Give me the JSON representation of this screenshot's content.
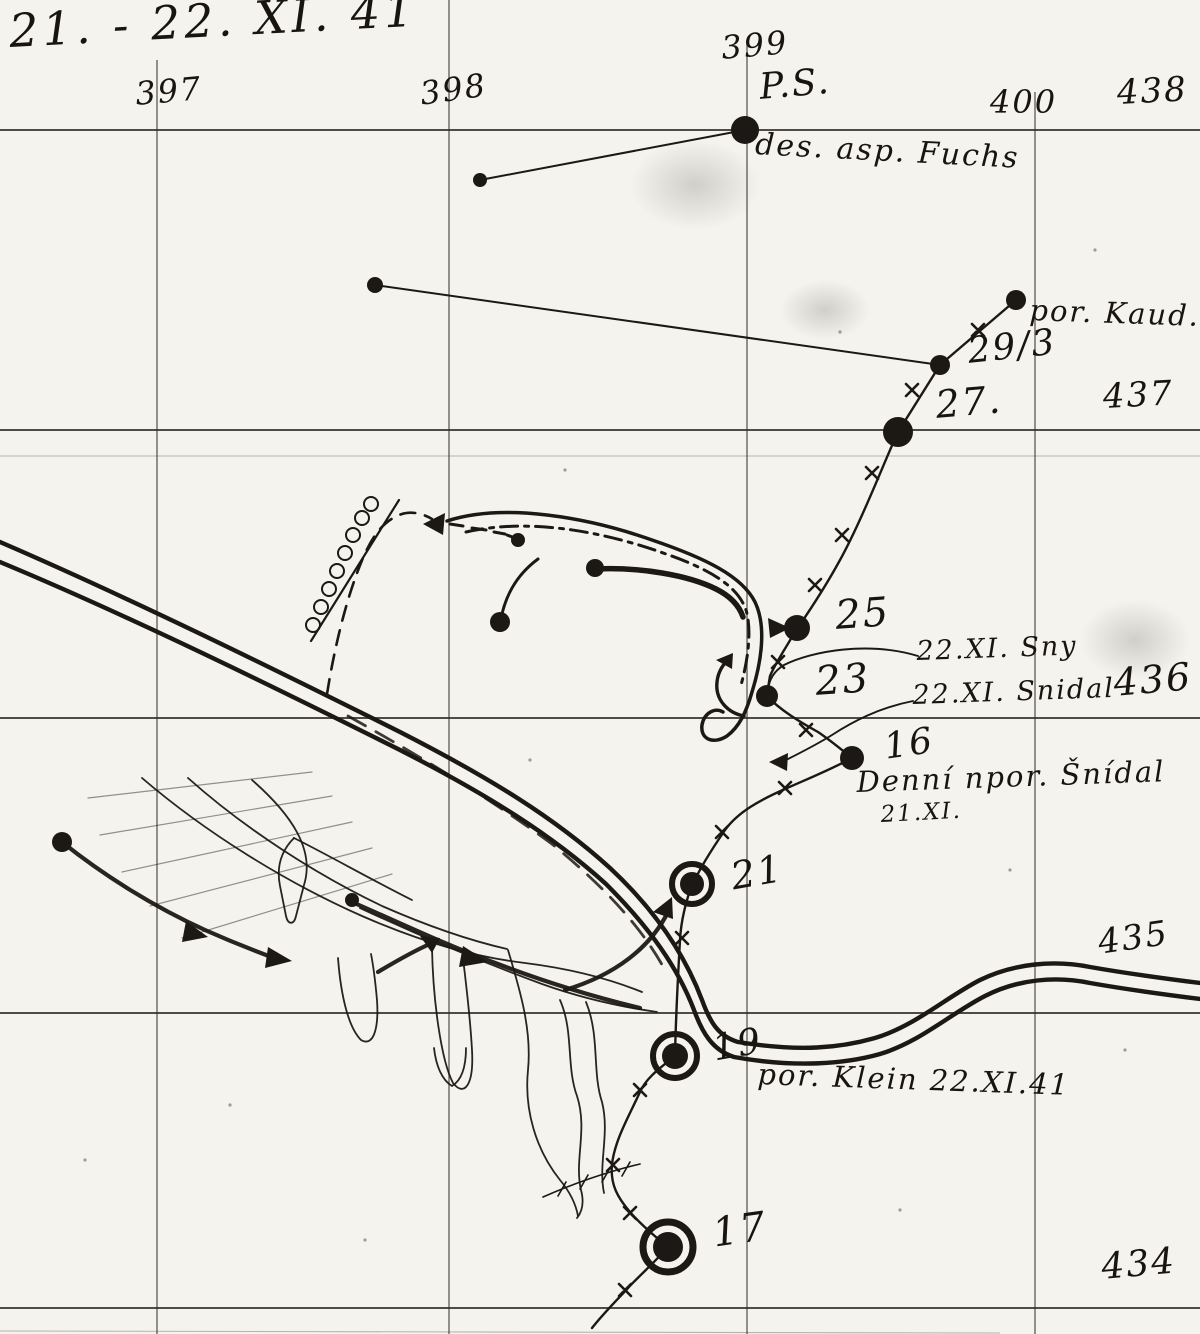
{
  "title": "21. - 22. XI. 41",
  "grid": {
    "columns": [
      "397",
      "398",
      "399",
      "400"
    ],
    "rows": [
      "438",
      "437",
      "436",
      "435",
      "434"
    ]
  },
  "labels": {
    "ps": "P.S.",
    "fuchs": "des. asp. Fuchs",
    "kaud": "por. Kaud.",
    "kaud_strength": "29/3",
    "p27": "27.",
    "p25": "25",
    "sny": "22.XI. Sny",
    "p23": "23",
    "snidal": "22.XI. Snidal",
    "p16": "16",
    "denni": "Denní npor. Šnídal",
    "denni_date": "21.XI.",
    "p21": "21",
    "p19": "19",
    "klein": "por. Klein 22.XI.41",
    "p17": "17"
  },
  "colors": {
    "ink": "#1b1815",
    "paper": "#f5f3ee",
    "grid_line": "#3c3831"
  }
}
